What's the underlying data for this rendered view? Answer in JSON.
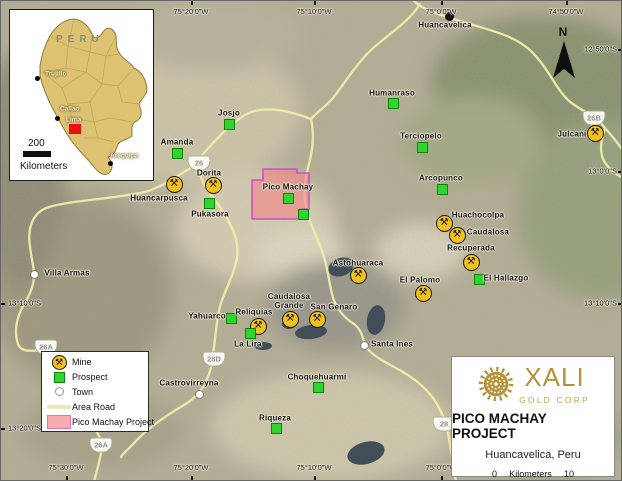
{
  "icons": {
    "mine_glyph": "⚒",
    "north_arrow": "north-arrow"
  },
  "colors": {
    "road": "#f1ecab",
    "mine_bg": "#f3c11b",
    "prospect_green": "#2fd42f",
    "project_fill": "#ef9ea2",
    "project_border": "#c654c6",
    "gold": "#b5923a",
    "lake": "#414d57"
  },
  "inset": {
    "country_label": "PERU",
    "scale_value": "200",
    "scale_unit": "Kilometers",
    "marker_color": "#e81010",
    "cities": [
      {
        "name": "Trujillo",
        "x": 27,
        "y": 68,
        "lx": 35,
        "ly": 64
      },
      {
        "name": "Callao",
        "x": 47,
        "y": 108,
        "lx": 50,
        "ly": 99,
        "nodot": false
      },
      {
        "name": "Lima",
        "x": 47,
        "y": 108,
        "lx": 56,
        "ly": 110,
        "nodot": true
      },
      {
        "name": "Arequipa",
        "x": 100,
        "y": 153,
        "lx": 100,
        "ly": 146
      }
    ]
  },
  "map": {
    "north_label": "N",
    "top_coords": [
      {
        "label": "75°20'0\"W",
        "x": 190
      },
      {
        "label": "75°10'0\"W",
        "x": 313
      },
      {
        "label": "75°0'0\"W",
        "x": 440
      },
      {
        "label": "74°50'0\"W",
        "x": 565
      }
    ],
    "bottom_coords": [
      {
        "label": "75°30'0\"W",
        "x": 65
      },
      {
        "label": "75°20'0\"W",
        "x": 190
      },
      {
        "label": "75°10'0\"W",
        "x": 313
      },
      {
        "label": "75°0'0\"W",
        "x": 440
      }
    ],
    "left_coords": [
      {
        "label": "13°10'0\"S",
        "y": 302
      },
      {
        "label": "13°20'0\"S",
        "y": 427
      }
    ],
    "right_coords": [
      {
        "label": "12°50'0\"S",
        "y": 48
      },
      {
        "label": "13°0'0\"S",
        "y": 170
      },
      {
        "label": "13°10'0\"S",
        "y": 302
      }
    ],
    "mines": [
      {
        "name": "Huancarpusca",
        "x": 173,
        "y": 183,
        "lx": 158,
        "ly": 197
      },
      {
        "name": "Dorita",
        "x": 212,
        "y": 184,
        "lx": 208,
        "ly": 172
      },
      {
        "name": "Pukasora*",
        "x": -100,
        "y": -100,
        "lx": -100,
        "ly": -100
      },
      {
        "name": "Julcani",
        "x": 594,
        "y": 132,
        "lx": 571,
        "ly": 133
      },
      {
        "name": "Huachocolpa",
        "x": 443,
        "y": 222,
        "lx": 477,
        "ly": 214
      },
      {
        "name": "Caudalosa",
        "x": 456,
        "y": 234,
        "lx": 487,
        "ly": 231
      },
      {
        "name": "Recuperada",
        "x": 470,
        "y": 261,
        "lx": 470,
        "ly": 247
      },
      {
        "name": "El Palomo",
        "x": 422,
        "y": 292,
        "lx": 419,
        "ly": 279
      },
      {
        "name": "Astohuaraca",
        "x": 357,
        "y": 274,
        "lx": 357,
        "ly": 262
      },
      {
        "name": "Caudalosa Grande",
        "x": 289,
        "y": 318,
        "lx": 288,
        "ly": 300,
        "w": 48
      },
      {
        "name": "San Genaro",
        "x": 316,
        "y": 318,
        "lx": 333,
        "ly": 306
      },
      {
        "name": "Reliquias",
        "x": 257,
        "y": 325,
        "lx": 253,
        "ly": 311
      }
    ],
    "prospects": [
      {
        "name": "Josjo",
        "x": 228,
        "y": 123,
        "lx": 228,
        "ly": 112
      },
      {
        "name": "Amanda",
        "x": 176,
        "y": 152,
        "lx": 176,
        "ly": 141
      },
      {
        "name": "Pukasora",
        "x": 208,
        "y": 202,
        "lx": 209,
        "ly": 213
      },
      {
        "name": "Pico Machay",
        "x": 287,
        "y": 197,
        "lx": 287,
        "ly": 186
      },
      {
        "name": "",
        "x": 302,
        "y": 213,
        "lx": 0,
        "ly": 0
      },
      {
        "name": "Humanraso",
        "x": 392,
        "y": 102,
        "lx": 391,
        "ly": 92
      },
      {
        "name": "Terciopelo",
        "x": 421,
        "y": 146,
        "lx": 420,
        "ly": 135
      },
      {
        "name": "Arcopunco",
        "x": 441,
        "y": 188,
        "lx": 440,
        "ly": 177
      },
      {
        "name": "El Hallazgo",
        "x": 478,
        "y": 278,
        "lx": 505,
        "ly": 277
      },
      {
        "name": "Yahuarco",
        "x": 230,
        "y": 317,
        "lx": 206,
        "ly": 315
      },
      {
        "name": "La Lira",
        "x": 249,
        "y": 332,
        "lx": 247,
        "ly": 343
      },
      {
        "name": "Choquehuarmi",
        "x": 317,
        "y": 386,
        "lx": 316,
        "ly": 376
      },
      {
        "name": "Riqueza",
        "x": 275,
        "y": 427,
        "lx": 274,
        "ly": 417
      }
    ],
    "towns": [
      {
        "name": "Huancavelica",
        "x": 448,
        "y": 15,
        "lx": 444,
        "ly": 24,
        "variant": "city"
      },
      {
        "name": "Villa Armas",
        "x": 33,
        "y": 273,
        "lx": 66,
        "ly": 272,
        "variant": "town"
      },
      {
        "name": "Santa Ines",
        "x": 363,
        "y": 344,
        "lx": 391,
        "ly": 343,
        "variant": "town"
      },
      {
        "name": "Castrovirreyna",
        "x": 198,
        "y": 393,
        "lx": 188,
        "ly": 382,
        "variant": "town"
      }
    ],
    "shields": [
      {
        "label": "26",
        "x": 198,
        "y": 162
      },
      {
        "label": "26B",
        "x": 593,
        "y": 117
      },
      {
        "label": "26A",
        "x": 45,
        "y": 346
      },
      {
        "label": "26A",
        "x": 100,
        "y": 444
      },
      {
        "label": "28D",
        "x": 213,
        "y": 358
      },
      {
        "label": "28",
        "x": 443,
        "y": 423
      }
    ]
  },
  "legend": {
    "items": [
      {
        "type": "mine",
        "label": "Mine"
      },
      {
        "type": "prospect",
        "label": "Prospect"
      },
      {
        "type": "town",
        "label": "Town"
      },
      {
        "type": "road",
        "label": "Area Road"
      },
      {
        "type": "project",
        "label": "Pico Machay Project"
      }
    ]
  },
  "title_block": {
    "company": "XALI",
    "division": "GOLD CORP",
    "title": "PICO MACHAY PROJECT",
    "subtitle": "Huancavelica, Peru",
    "scale_start": "0",
    "scale_unit": "Kilometers",
    "scale_end": "10"
  }
}
